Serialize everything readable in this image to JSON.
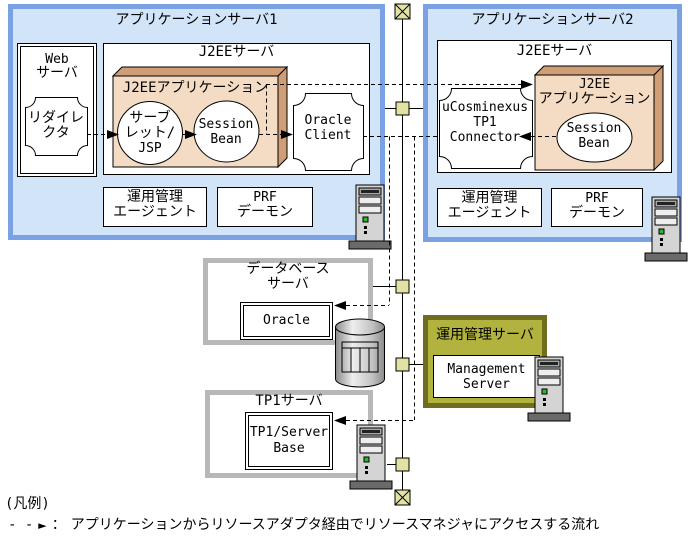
{
  "colors": {
    "server_box_fill": "#d2e4f8",
    "server_box_border": "#79a1e3",
    "component_3d_front": "#f4dcc4",
    "component_3d_side": "#cf9e76",
    "mgmt_box_fill": "#b2b23e",
    "mgmt_box_border": "#6e6e1e",
    "gray_box_border": "#b8b8b8",
    "network_node_fill": "#e2e2a2"
  },
  "app1": {
    "title": "アプリケーションサーバ1",
    "web_server": {
      "title": [
        "Web",
        "サーバ"
      ],
      "redirector": [
        "リダイレ",
        "クタ"
      ]
    },
    "j2ee_server": {
      "title": "J2EEサーバ",
      "application_label": "J2EEアプリケーション",
      "servlet_jsp": [
        "サーブ",
        "レット/",
        "JSP"
      ],
      "session_bean": [
        "Session",
        "Bean"
      ],
      "oracle_client": [
        "Oracle",
        "Client"
      ]
    },
    "ops_agent": [
      "運用管理",
      "エージェント"
    ],
    "prf_daemon": [
      "PRF",
      "デーモン"
    ]
  },
  "app2": {
    "title": "アプリケーションサーバ2",
    "j2ee_server": {
      "title": "J2EEサーバ",
      "tp1_connector": [
        "uCosminexus",
        "TP1",
        "Connector"
      ],
      "application_label": [
        "J2EE",
        "アプリケーション"
      ],
      "session_bean": [
        "Session",
        "Bean"
      ]
    },
    "ops_agent": [
      "運用管理",
      "エージェント"
    ],
    "prf_daemon": [
      "PRF",
      "デーモン"
    ]
  },
  "database_server": {
    "title": [
      "データベース",
      "サーバ"
    ],
    "oracle": "Oracle"
  },
  "management_server": {
    "title": "運用管理サーバ",
    "product": [
      "Management",
      "Server"
    ]
  },
  "tp1_server": {
    "title": "TP1サーバ",
    "server_base": [
      "TP1/Server",
      "Base"
    ]
  },
  "legend": {
    "label": "(凡例)",
    "dashes": "- -",
    "arrow": "►",
    "separator": "：",
    "text": "アプリケーションからリソースアダプタ経由でリソースマネジャにアクセスする流れ"
  }
}
